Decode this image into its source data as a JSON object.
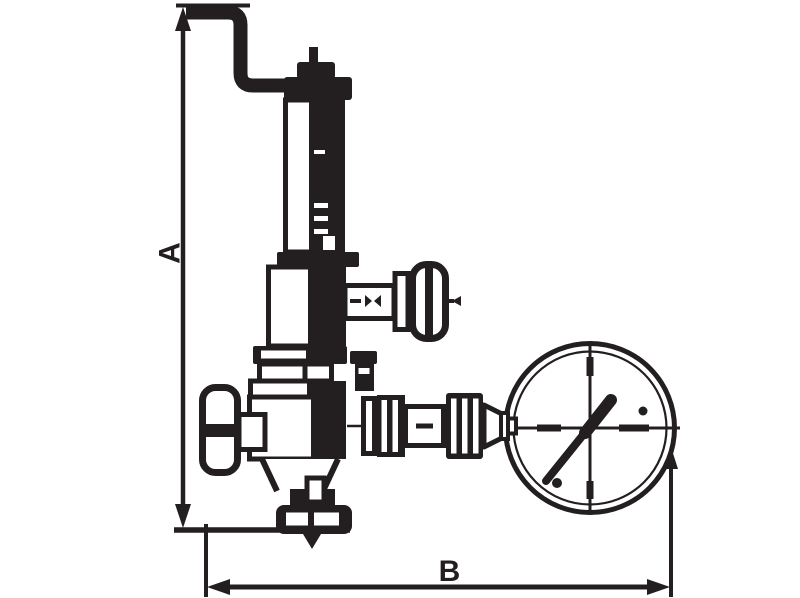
{
  "diagram": {
    "type": "technical line drawing",
    "subject": "safety relief valve with bent vent pipe and pressure gauge, dimensioned",
    "ink_color": "#231f20",
    "background_color": "#ffffff",
    "dimension_labels": {
      "height": "A",
      "width": "B"
    },
    "components": {
      "vent_pipe": "bent vent pipe (top)",
      "spring_housing": "spring housing column",
      "side_knob": "side outlet knob (upper right)",
      "handwheel": "handwheel (left)",
      "valve_body": "valve body",
      "gauge_connection": "union and nut fittings to gauge",
      "pressure_gauge": "pressure gauge with needle",
      "outlet_arrow": "downward flow arrow at bottom outlet"
    }
  }
}
